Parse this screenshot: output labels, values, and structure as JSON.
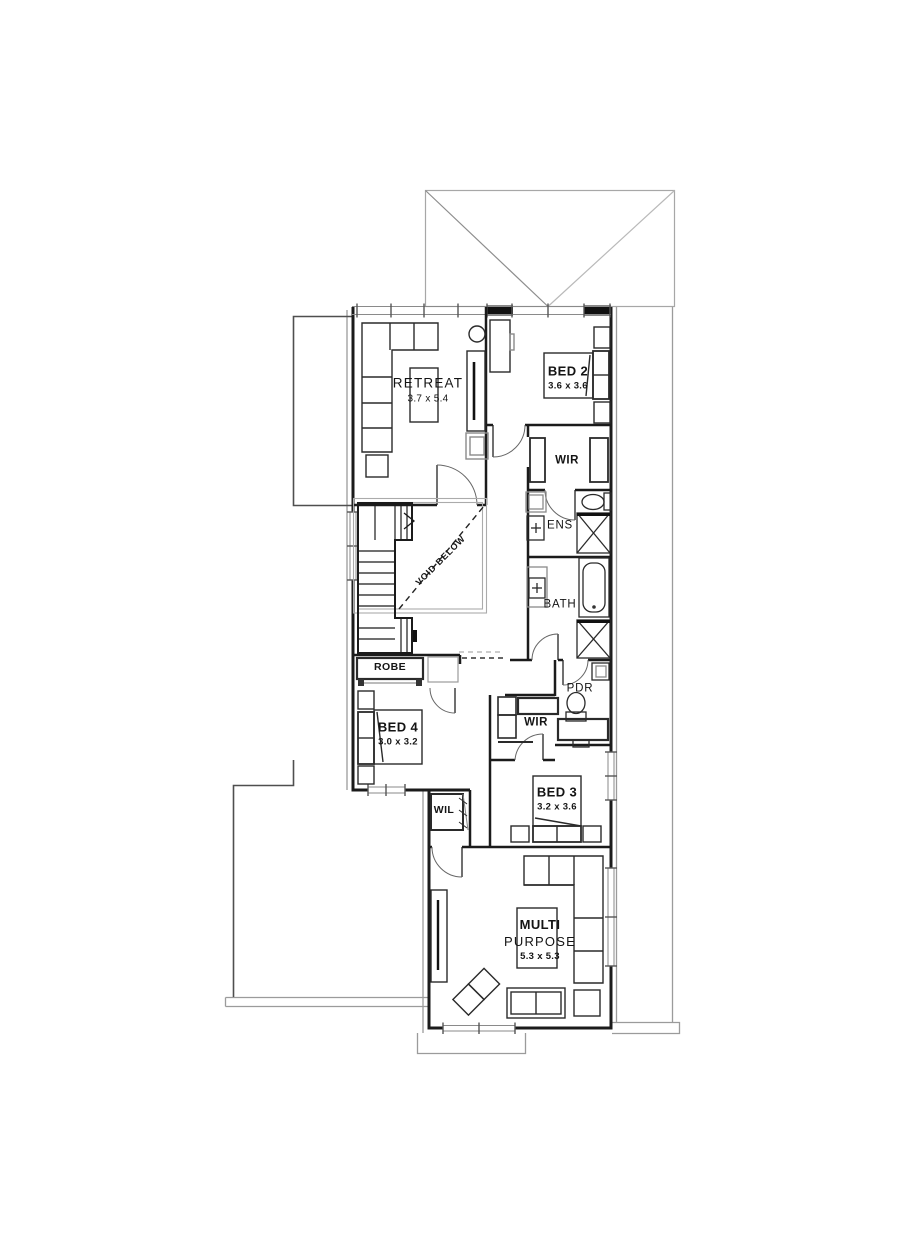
{
  "colors": {
    "wall": "#1b1b1b",
    "furniture": "#2a2a2a",
    "light_outline": "#9b9b9b",
    "text": "#141414"
  },
  "rooms": {
    "retreat": {
      "name": "RETREAT",
      "dims": "3.7 x 5.4"
    },
    "bed2": {
      "name": "BED 2",
      "dims": "3.6 x 3.6"
    },
    "wir_top": {
      "name": "WIR"
    },
    "ens": {
      "name": "ENS"
    },
    "bath": {
      "name": "BATH"
    },
    "void": {
      "name": "VOID BELOW"
    },
    "robe": {
      "name": "ROBE"
    },
    "bed4": {
      "name": "BED 4",
      "dims": "3.0 x 3.2"
    },
    "pdr": {
      "name": "PDR"
    },
    "wir_mid": {
      "name": "WIR"
    },
    "bed3": {
      "name": "BED 3",
      "dims": "3.2 x 3.6"
    },
    "wil": {
      "name": "WIL"
    },
    "multi": {
      "line1": "MULTI",
      "line2": "PURPOSE",
      "dims": "5.3 x 5.3"
    }
  }
}
